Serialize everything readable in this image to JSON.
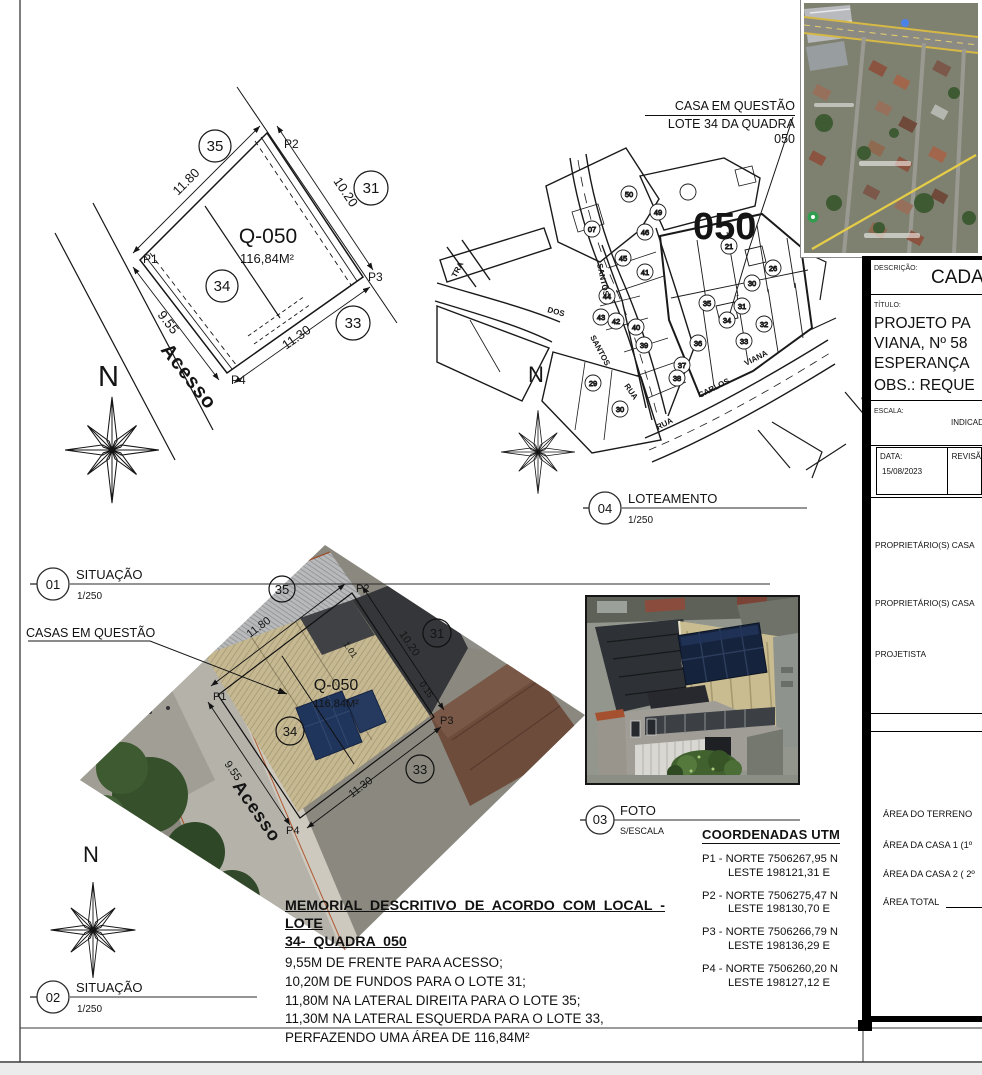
{
  "callouts": {
    "casa_line1": "CASA EM QUESTÃO",
    "casa_line2": "LOTE 34 DA QUADRA 050",
    "casas": "CASAS EM QUESTÃO"
  },
  "north_letter": "N",
  "balloons": {
    "b01": {
      "num": "01",
      "title": "SITUAÇÃO",
      "scale": "1/250"
    },
    "b02": {
      "num": "02",
      "title": "SITUAÇÃO",
      "scale": "1/250"
    },
    "b03": {
      "num": "03",
      "title": "FOTO",
      "scale": "S/ESCALA"
    },
    "b04": {
      "num": "04",
      "title": "LOTEAMENTO",
      "scale": "1/250"
    }
  },
  "lot": {
    "code": "Q-050",
    "area": "116,84M²",
    "p1": "P1",
    "p2": "P2",
    "p3": "P3",
    "p4": "P4",
    "dim_right": "11.80",
    "dim_back": "10.20",
    "dim_left": "11.30",
    "dim_front": "9.55",
    "d_small1": "1.01",
    "d_small2": "0.15",
    "n35": "35",
    "n31": "31",
    "n33": "33",
    "n34": "34",
    "street": "Acesso"
  },
  "loteamento": {
    "quadra": "050",
    "streets": {
      "santos_a": "SANTOS",
      "dos": "DOS",
      "santos_b": "SANTOS",
      "rua_a": "RUA",
      "rua_b": "RUA",
      "carlos": "CARLOS",
      "viana": "VIANA",
      "tra": "TRA"
    },
    "lots": [
      "50",
      "07",
      "49",
      "46",
      "21",
      "45",
      "41",
      "44",
      "26",
      "30",
      "43",
      "42",
      "40",
      "35",
      "31",
      "34",
      "32",
      "39",
      "36",
      "33",
      "37",
      "38",
      "29",
      "30"
    ]
  },
  "titleblock": {
    "descricao_label": "DESCRIÇÃO:",
    "descricao_value": "CADA",
    "titulo_label": "TÍTULO:",
    "titulo_lines": [
      "PROJETO PA",
      "VIANA, Nº 58",
      "ESPERANÇA",
      "OBS.: REQUE"
    ],
    "escala_label": "ESCALA:",
    "escala_value": "INDICADA",
    "data_label": "DATA:",
    "data_value": "15/08/2023",
    "revisao_label": "REVISÃ",
    "prop1_label": "PROPRIETÁRIO(S) CASA",
    "prop2_label": "PROPRIETÁRIO(S) CASA",
    "projetista_label": "PROJETISTA",
    "area_terreno": "ÁREA  DO TERRENO",
    "area_casa1": "ÁREA DA CASA 1 (1º",
    "area_casa2": "ÁREA DA CASA 2 ( 2º",
    "area_total": "ÁREA TOTAL"
  },
  "coordenadas": {
    "header": "COORDENADAS UTM",
    "points": [
      {
        "id": "P1 -",
        "norte": "NORTE 7506267,95 N",
        "leste": "LESTE 198121,31 E"
      },
      {
        "id": "P2 -",
        "norte": "NORTE 7506275,47 N",
        "leste": "LESTE 198130,70 E"
      },
      {
        "id": "P3 -",
        "norte": "NORTE 7506266,79 N",
        "leste": "LESTE 198136,29 E"
      },
      {
        "id": "P4 -",
        "norte": "NORTE 7506260,20 N",
        "leste": "LESTE 198127,12 E"
      }
    ]
  },
  "memorial": {
    "title1": "MEMORIAL DESCRITIVO DE ACORDO COM LOCAL - LOTE",
    "title2": "34- QUADRA 050",
    "lines": [
      "9,55M DE FRENTE PARA ACESSO;",
      "10,20M DE FUNDOS PARA O LOTE 31;",
      "11,80M NA LATERAL DIREITA PARA O LOTE 35;",
      "11,30M NA LATERAL ESQUERDA PARA O LOTE 33,",
      "PERFAZENDO UMA ÁREA DE 116,84M²"
    ]
  }
}
